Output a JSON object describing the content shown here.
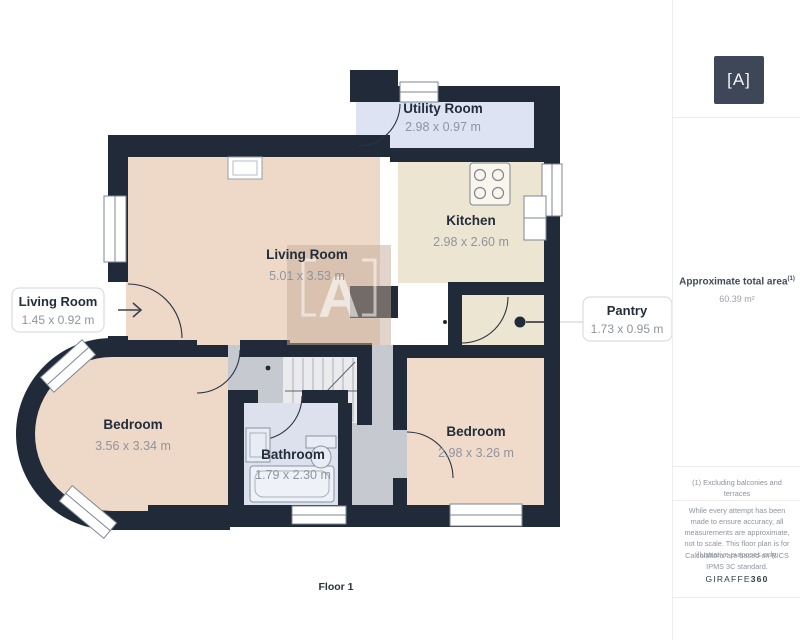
{
  "plan": {
    "floor_label": "Floor 1",
    "watermark_letter": "A",
    "rooms": {
      "utility": {
        "name": "Utility Room",
        "dims": "2.98 x 0.97 m"
      },
      "kitchen": {
        "name": "Kitchen",
        "dims": "2.98 x 2.60 m"
      },
      "living": {
        "name": "Living Room",
        "dims": "5.01 x 3.53 m"
      },
      "living_small": {
        "name": "Living Room",
        "dims": "1.45 x 0.92 m"
      },
      "pantry": {
        "name": "Pantry",
        "dims": "1.73 x 0.95 m"
      },
      "bedroom_left": {
        "name": "Bedroom",
        "dims": "3.56 x 3.34 m"
      },
      "bathroom": {
        "name": "Bathroom",
        "dims": "1.79 x 2.30 m"
      },
      "bedroom_right": {
        "name": "Bedroom",
        "dims": "2.98 x 3.26 m"
      }
    }
  },
  "sidebar": {
    "logo_glyph": "[A]",
    "total_area_label": "Approximate total area",
    "total_area_superscript": "(1)",
    "total_area_value": "60.39 m²",
    "footnote": "(1) Excluding balconies and terraces",
    "disclaimer": "While every attempt has been made to ensure accuracy, all measurements are approximate, not to scale. This floor plan is for illustrative purposes only.",
    "standard_note": "Calculations are based on RICS IPMS 3C standard.",
    "brand_name": "GIRAFFE",
    "brand_suffix": "360"
  },
  "colors": {
    "wall": "#202a38",
    "floor_warm": "#eed8c7",
    "floor_cream": "#ece5d1",
    "floor_lavender": "#dde3f3",
    "floor_bath": "#dce1ed",
    "hall_gray": "#c6c9cf",
    "stairs": "#ebebee",
    "logo_bg": "#3e4757",
    "text_dark": "#232d3b",
    "text_gray": "#8f949d"
  }
}
